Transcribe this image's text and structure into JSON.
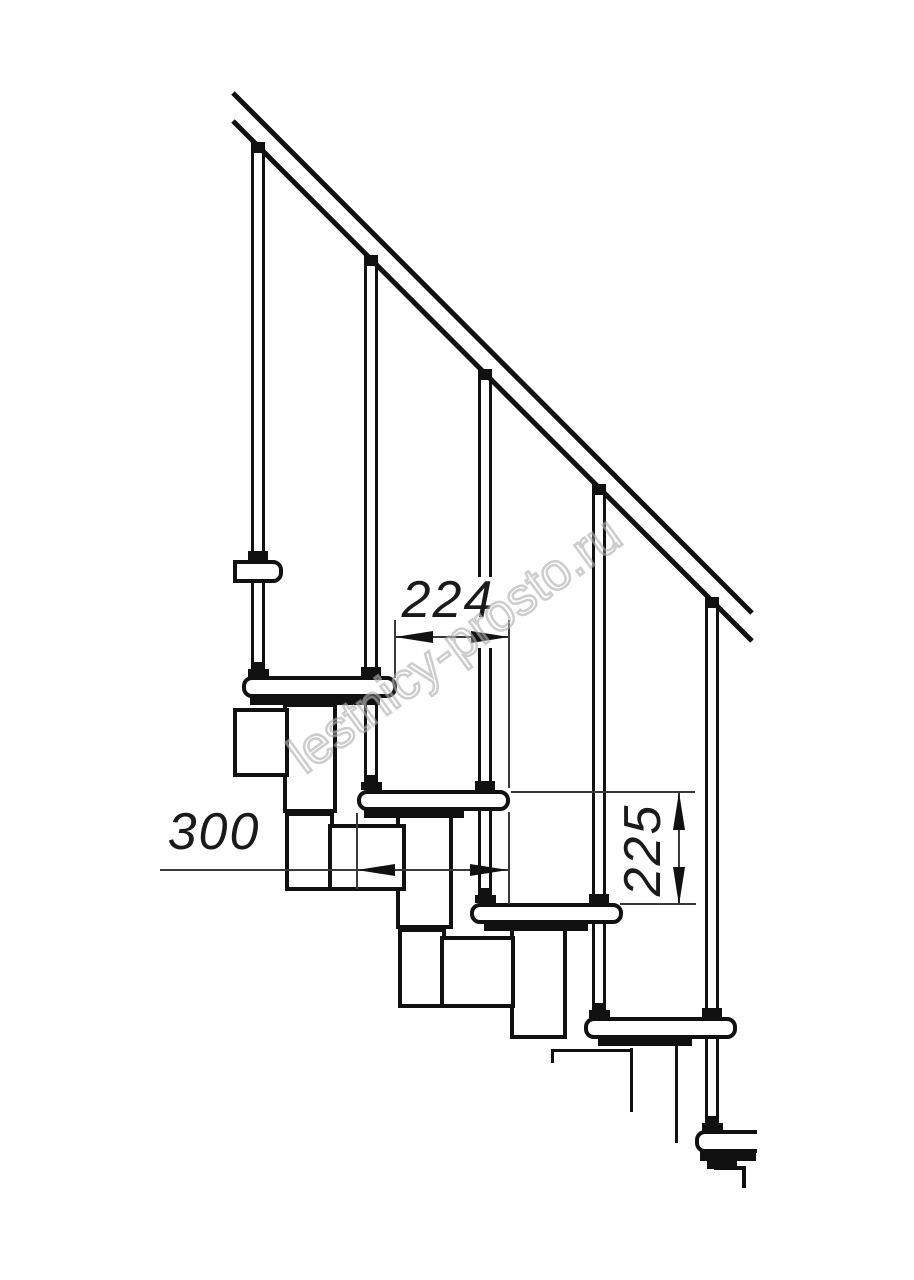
{
  "drawing": {
    "watermark": "lestnicy-prosto.ru",
    "dimensions": {
      "step_run": {
        "label": "224",
        "orientation": "horizontal"
      },
      "tread_depth": {
        "label": "300",
        "orientation": "horizontal"
      },
      "riser_height": {
        "label": "225",
        "orientation": "vertical"
      }
    },
    "colors": {
      "line": "#111111",
      "dimension_line": "#3a3a3a",
      "watermark": "#c4c4c4",
      "background": "#ffffff"
    }
  }
}
